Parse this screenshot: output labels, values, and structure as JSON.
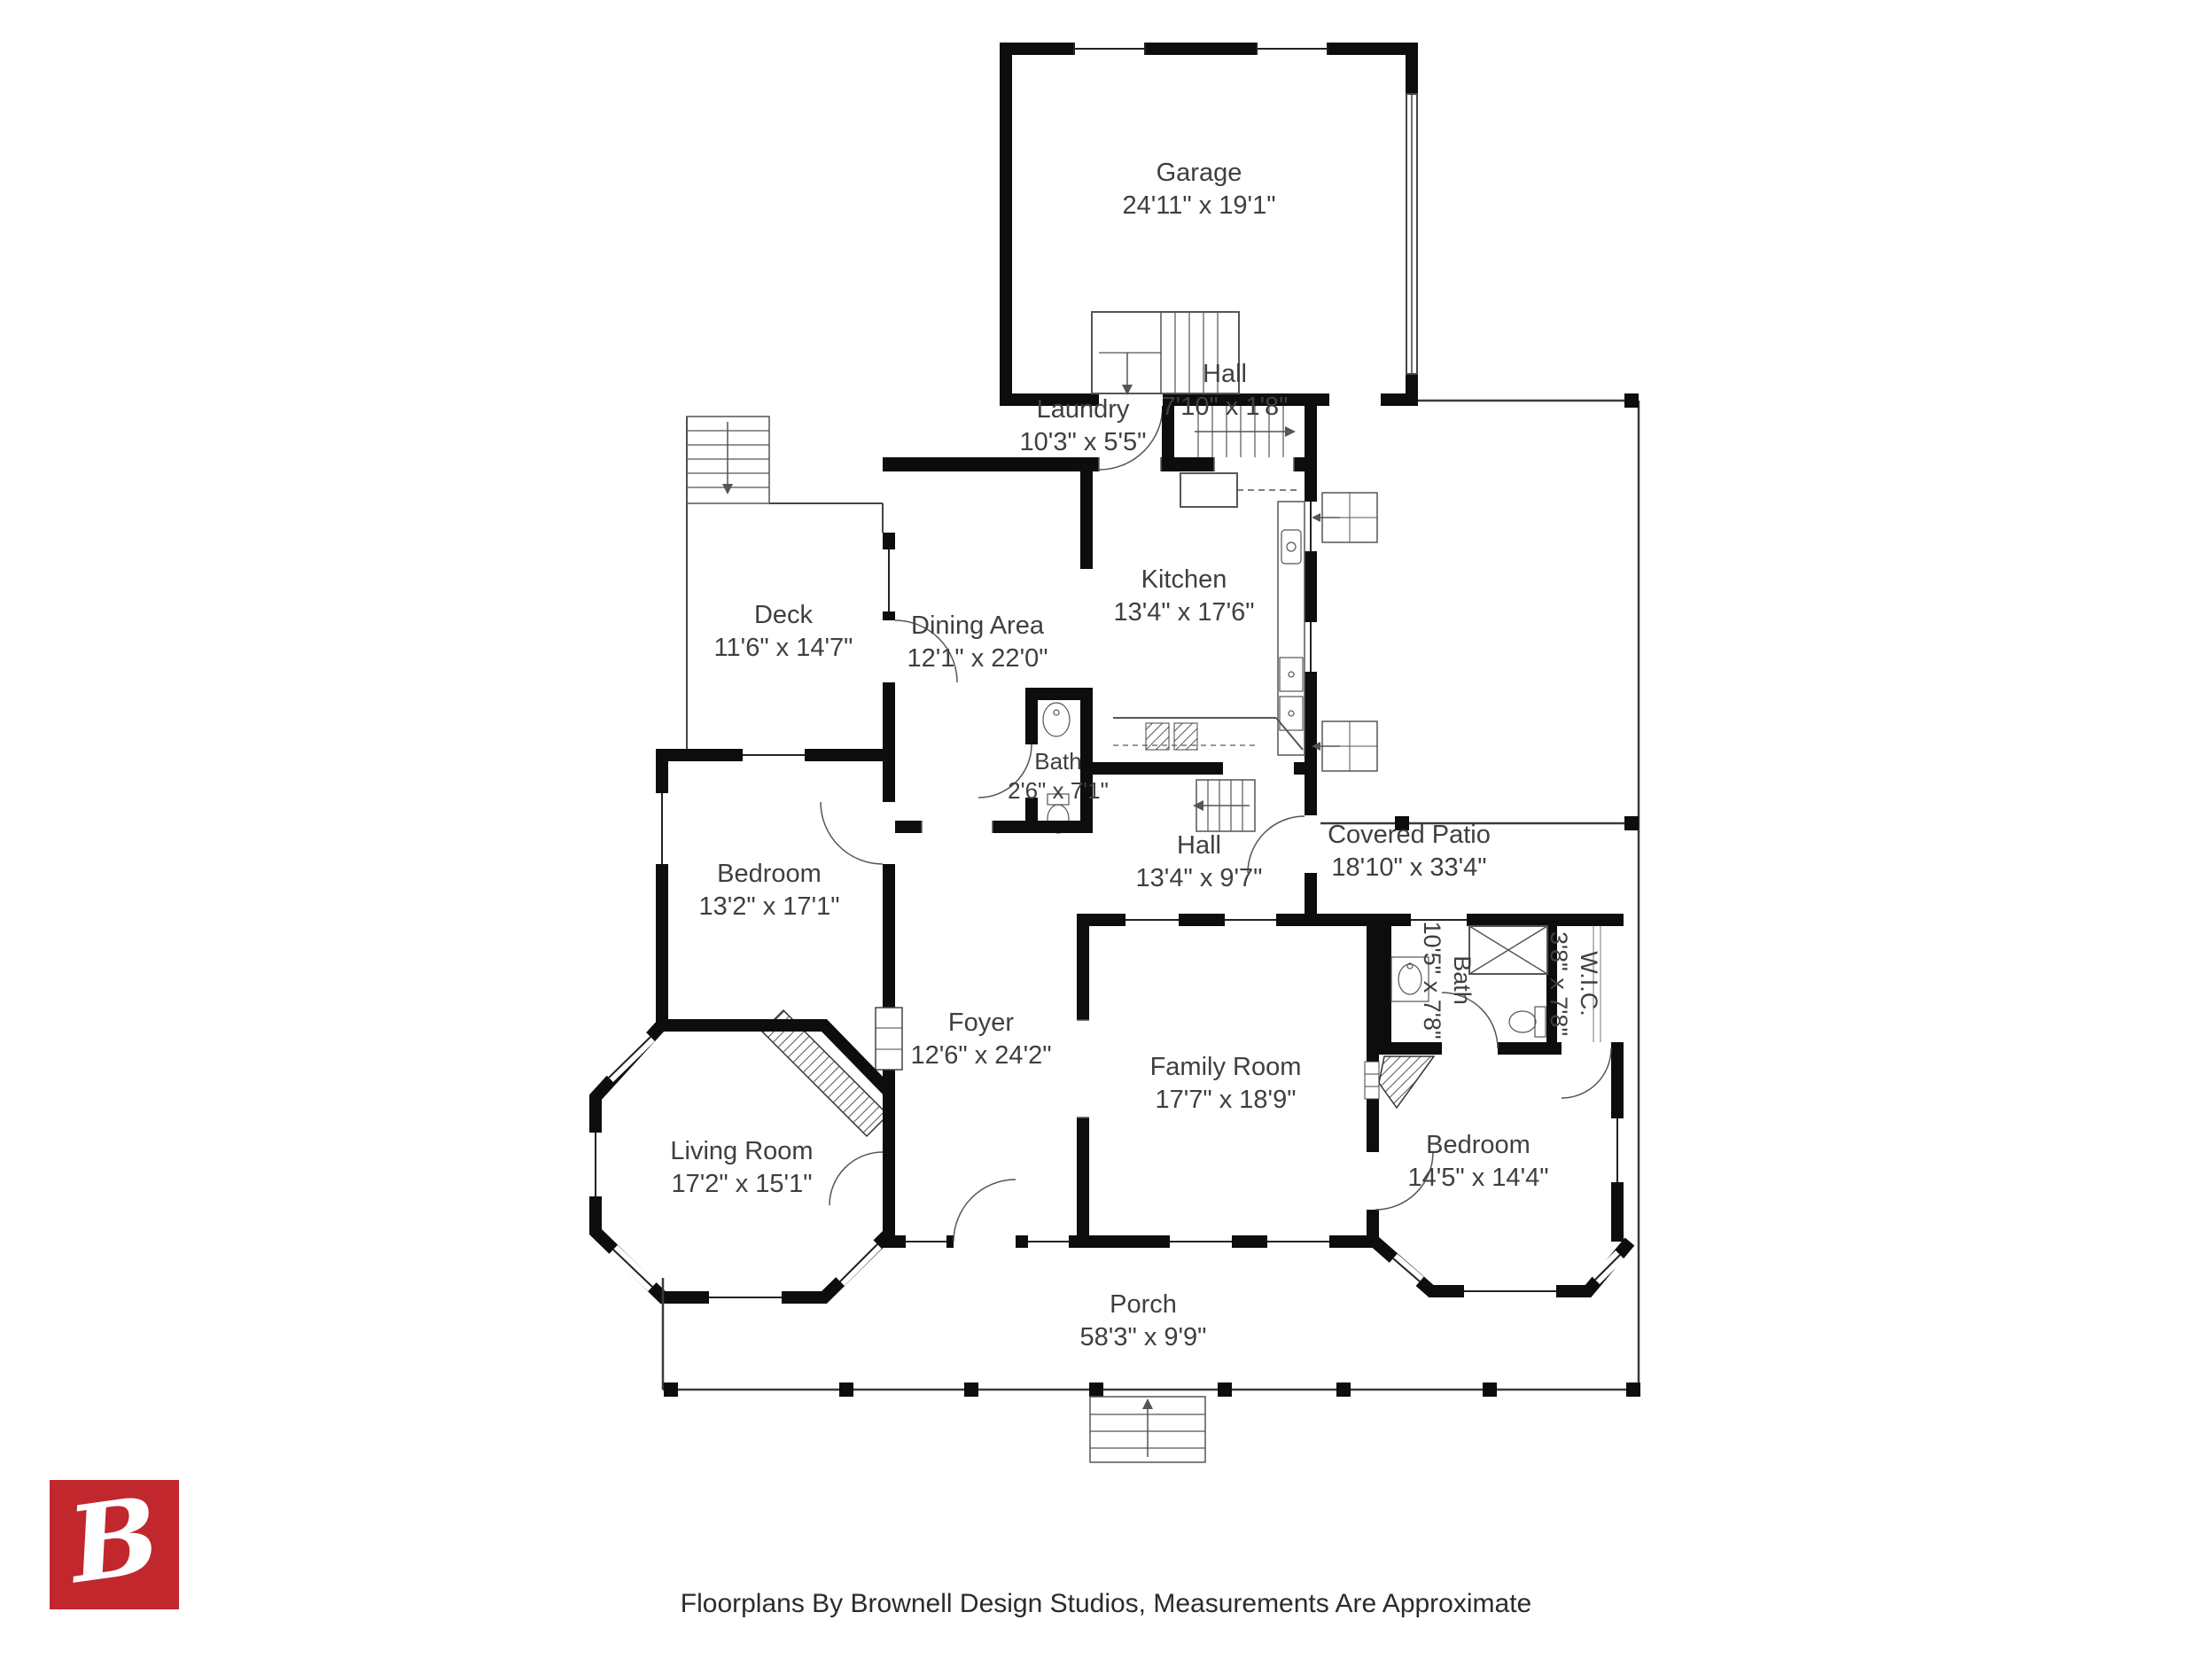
{
  "branding": {
    "logo_letter": "B",
    "logo_color": "#c1272d",
    "footer_text": "Floorplans By Brownell Design Studios, Measurements Are Approximate"
  },
  "rooms": {
    "garage": {
      "name": "Garage",
      "dims": "24'11\" x 19'1\""
    },
    "hall_upper": {
      "name": "Hall",
      "dims": "7'10\" x 1'8\""
    },
    "laundry": {
      "name": "Laundry",
      "dims": "10'3\" x 5'5\""
    },
    "kitchen": {
      "name": "Kitchen",
      "dims": "13'4\" x 17'6\""
    },
    "dining": {
      "name": "Dining Area",
      "dims": "12'1\" x 22'0\""
    },
    "deck": {
      "name": "Deck",
      "dims": "11'6\" x 14'7\""
    },
    "bath_small": {
      "name": "Bath",
      "dims": "2'6\" x 7'1\""
    },
    "hall_lower": {
      "name": "Hall",
      "dims": "13'4\" x 9'7\""
    },
    "covered_patio": {
      "name": "Covered Patio",
      "dims": "18'10\" x 33'4\""
    },
    "bedroom_upper": {
      "name": "Bedroom",
      "dims": "13'2\" x 17'1\""
    },
    "foyer": {
      "name": "Foyer",
      "dims": "12'6\" x 24'2\""
    },
    "family_room": {
      "name": "Family Room",
      "dims": "17'7\" x 18'9\""
    },
    "bath_main": {
      "name": "Bath",
      "dims": "10'5\" x 7'8\""
    },
    "wic": {
      "name": "W.I.C.",
      "dims": "3'8\" x 7'8\""
    },
    "living_room": {
      "name": "Living Room",
      "dims": "17'2\" x 15'1\""
    },
    "bedroom_lower": {
      "name": "Bedroom",
      "dims": "14'5\" x 14'4\""
    },
    "porch": {
      "name": "Porch",
      "dims": "58'3\" x 9'9\""
    }
  }
}
